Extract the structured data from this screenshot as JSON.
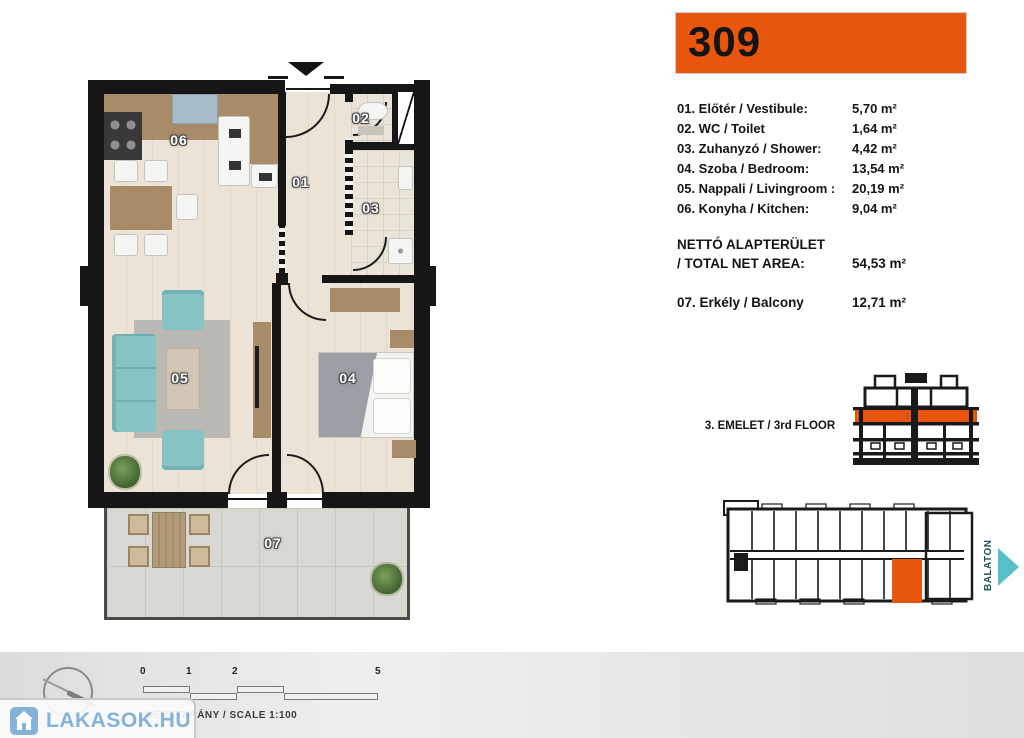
{
  "unit_number": "309",
  "colors": {
    "accent_orange": "#e8560e",
    "teal_arrow": "#56c0c6",
    "logo_blue": "#85b2d8"
  },
  "room_list": [
    {
      "label": "01. Előtér / Vestibule:",
      "area": "5,70 m²"
    },
    {
      "label": "02. WC / Toilet",
      "area": "1,64 m²"
    },
    {
      "label": "03. Zuhanyzó / Shower:",
      "area": "4,42 m²"
    },
    {
      "label": "04. Szoba / Bedroom:",
      "area": "13,54 m²"
    },
    {
      "label": "05. Nappali / Livingroom :",
      "area": "20,19 m²"
    },
    {
      "label": "06. Konyha / Kitchen:",
      "area": "9,04 m²"
    }
  ],
  "total_area": {
    "line1": "NETTÓ ALAPTERÜLET",
    "line2": "/ TOTAL NET AREA:",
    "value": "54,53 m²"
  },
  "balcony_row": {
    "label": "07. Erkély / Balcony",
    "value": "12,71 m²"
  },
  "floor_indicator": "3. EMELET / 3rd FLOOR",
  "direction_label": "BALATON",
  "plan_room_numbers": {
    "hall": "01",
    "wc": "02",
    "shower": "03",
    "bedroom": "04",
    "living": "05",
    "kitchen": "06",
    "balcony": "07"
  },
  "scale": {
    "ticks": [
      "0",
      "1",
      "2",
      "5"
    ],
    "caption": "MÉRETARÁNY / SCALE  1:100"
  },
  "watermark": "LAKASOK.HU",
  "edge_text": [
    "A",
    "6",
    "A",
    "7"
  ]
}
